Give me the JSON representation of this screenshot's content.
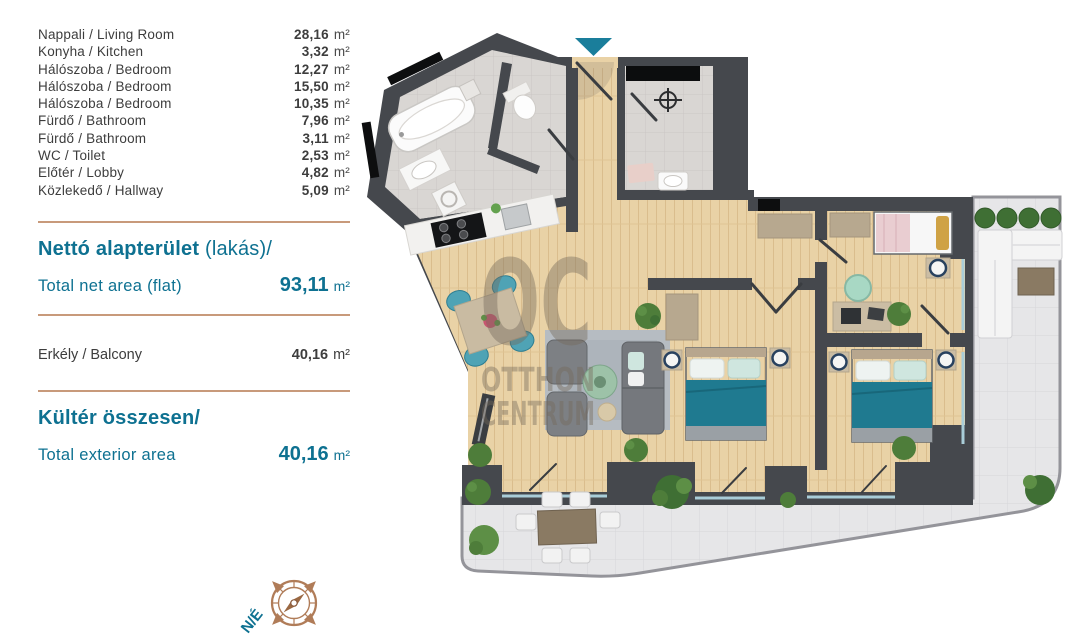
{
  "left_panel": {
    "rooms": [
      {
        "label": "Nappali / Living Room",
        "value": "28,16",
        "unit": "m²"
      },
      {
        "label": "Konyha / Kitchen",
        "value": "3,32",
        "unit": "m²"
      },
      {
        "label": "Hálószoba / Bedroom",
        "value": "12,27",
        "unit": "m²"
      },
      {
        "label": "Hálószoba / Bedroom",
        "value": "15,50",
        "unit": "m²"
      },
      {
        "label": "Hálószoba / Bedroom",
        "value": "10,35",
        "unit": "m²"
      },
      {
        "label": "Fürdő / Bathroom",
        "value": "7,96",
        "unit": "m²"
      },
      {
        "label": "Fürdő / Bathroom",
        "value": "3,11",
        "unit": "m²"
      },
      {
        "label": "WC / Toilet",
        "value": "2,53",
        "unit": "m²"
      },
      {
        "label": "Előtér / Lobby",
        "value": "4,82",
        "unit": "m²"
      },
      {
        "label": "Közlekedő / Hallway",
        "value": "5,09",
        "unit": "m²"
      }
    ],
    "net_area": {
      "title_bold": "Nettó alapterület",
      "title_rest": " (lakás)/",
      "subtitle": "Total net area (flat)",
      "value": "93,11",
      "unit": "m²"
    },
    "balcony": {
      "label": "Erkély / Balcony",
      "value": "40,16",
      "unit": "m²"
    },
    "exterior": {
      "title": "Kültér összesen/",
      "subtitle": "Total exterior area",
      "value": "40,16",
      "unit": "m²"
    }
  },
  "floorplan": {
    "watermark": {
      "line1": "OC",
      "line2": "OTTHON",
      "line3": "CENTRUM"
    },
    "compass": {
      "label": "N/É"
    }
  },
  "colors": {
    "teal_heading": "#0e7191",
    "copper_divider": "#c89a7b",
    "entrance_marker": "#1a7e9b",
    "wall": "#45484d",
    "wood_floor": "#e9d2a6",
    "bath_tile": "#d9d6d3",
    "terrace_tile": "#e6e6e8",
    "bed_teal": "#1f7a90",
    "compass_copper": "#b07c58",
    "text_dark": "#3d3d3d"
  }
}
